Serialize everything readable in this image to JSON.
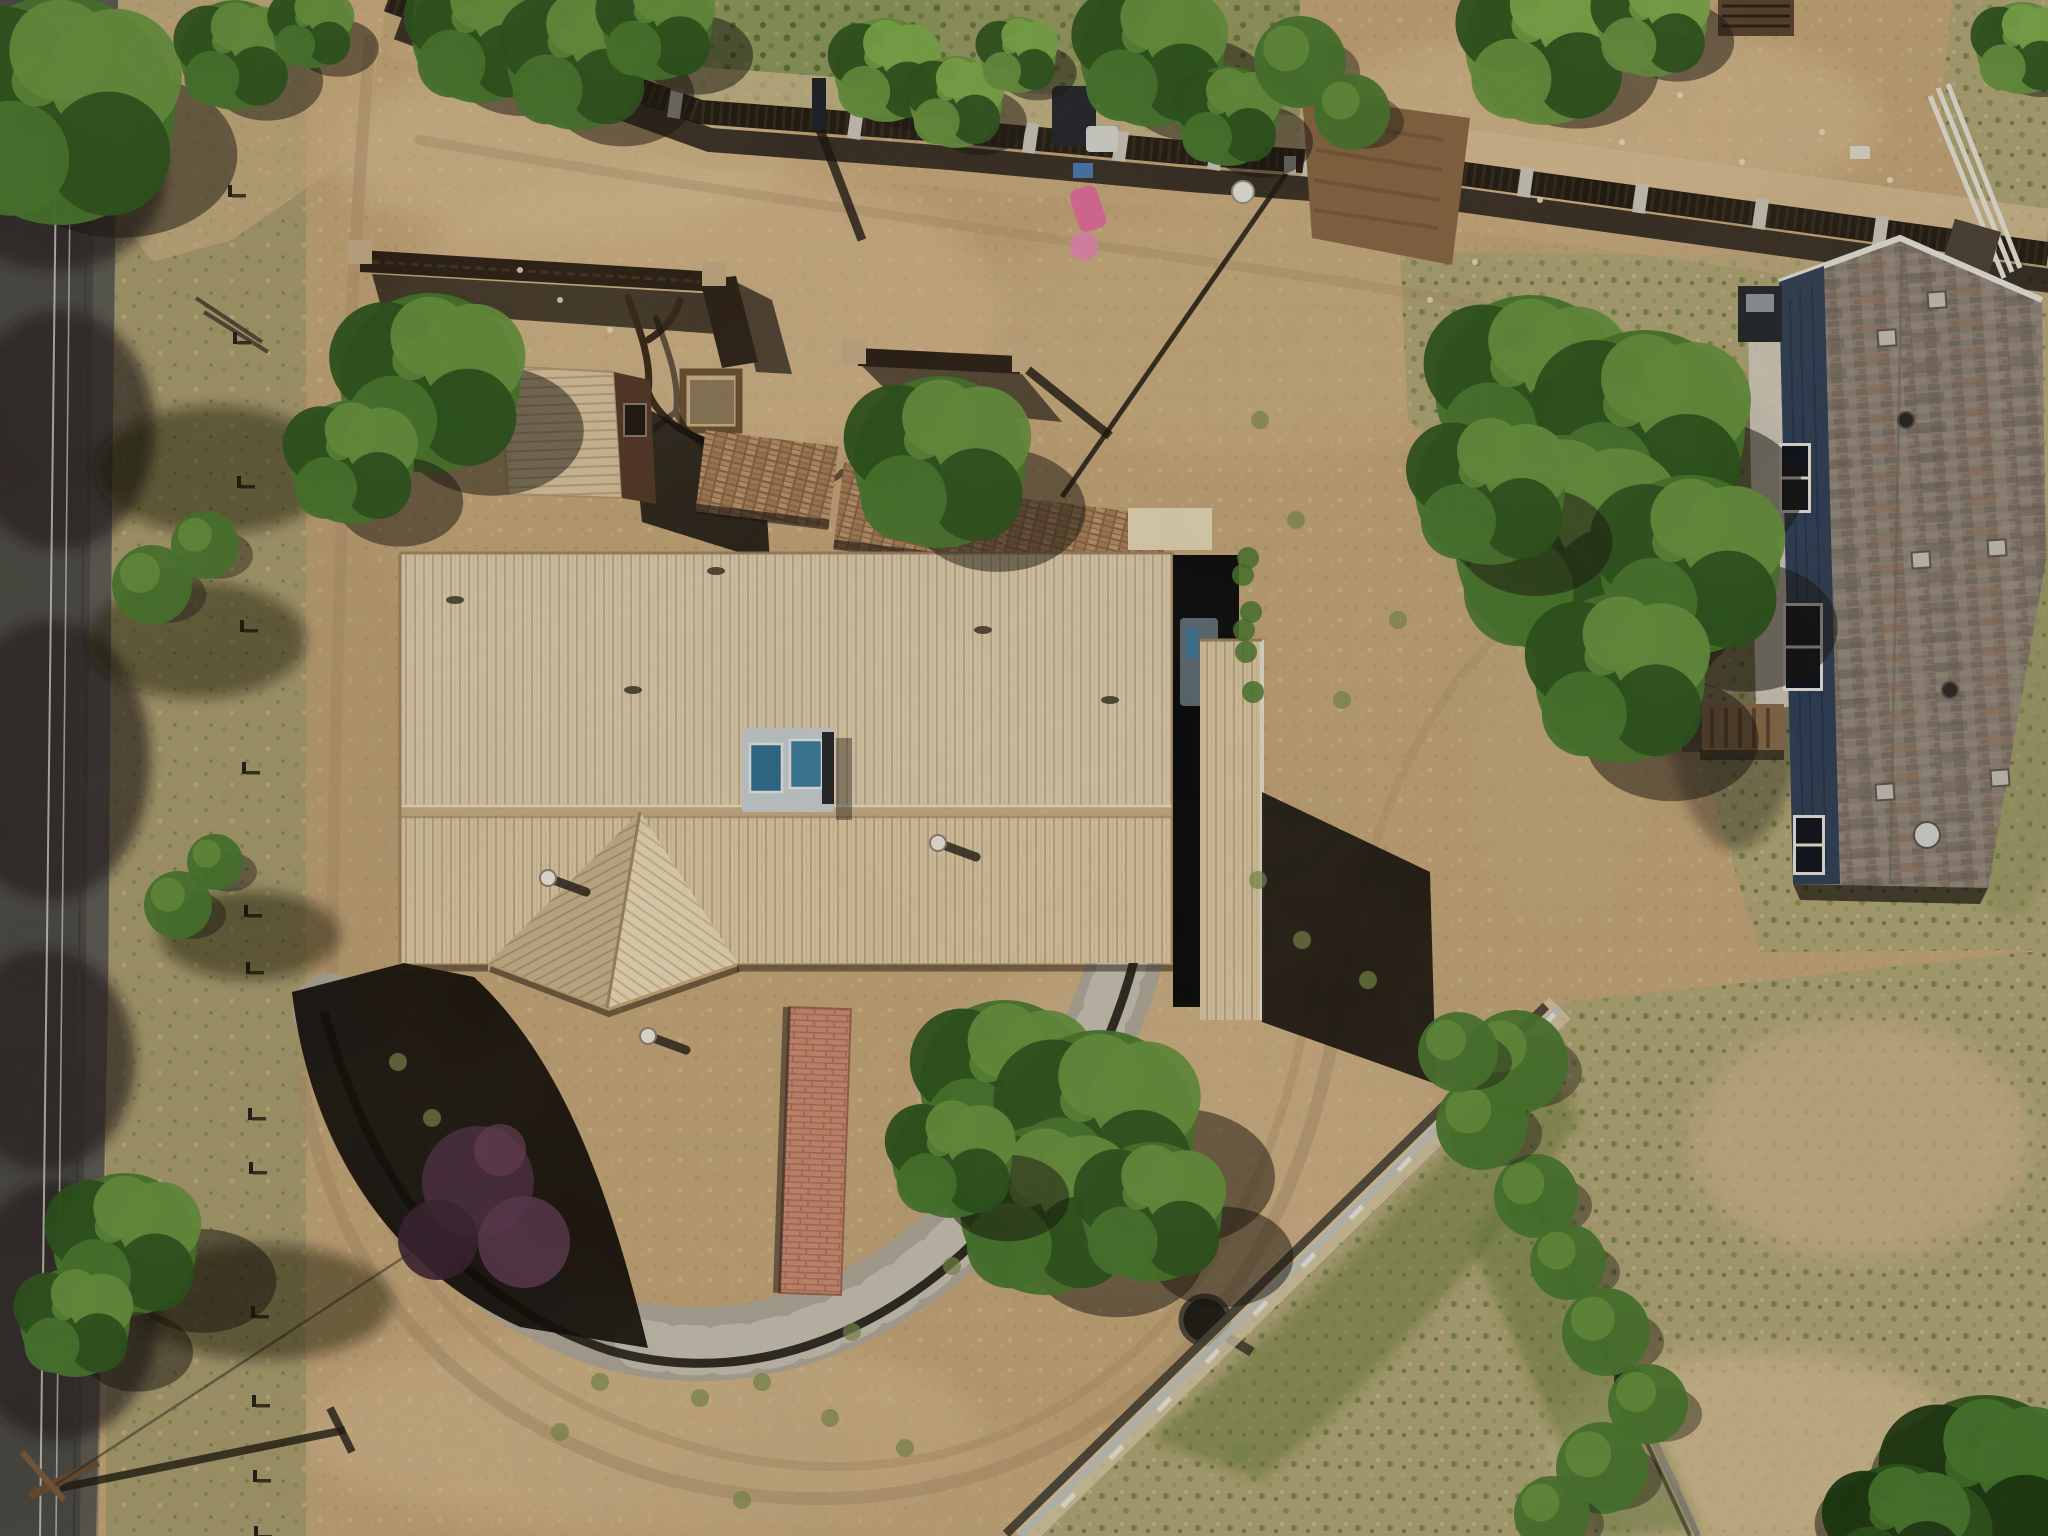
{
  "meta": {
    "image_kind": "aerial-drone-photo",
    "subject": "rural residential property, top-down view",
    "visible_text": ""
  },
  "palette": {
    "dirt_base": "#c7a87a",
    "dirt_light": "#dcbf94",
    "dirt_lighter": "#e8d0a6",
    "dirt_shade": "#b2946a",
    "track": "#b39识6e",
    "track_line": "#b1946b",
    "scrub": "#ab9e70",
    "grass_dry": "#b3a878",
    "grass_green": "#7f8f4e",
    "grass_dark": "#5a6a36",
    "road": "#4b4a45",
    "road_light": "#7b786f",
    "road_shadow": "#22211e",
    "wire": "#d9d9d2",
    "shadow": "#17130d",
    "tree_green": "#4a7a2e",
    "tree_light": "#69963f",
    "tree_dark": "#2e561d",
    "tree_bright": "#7fae4c",
    "roof_tan": "#e2cfab",
    "roof_rib": "#c3ab83",
    "roof_prow_left": "#cdb690",
    "roof_prow_right": "#eedebb",
    "roof_edge": "#9b835f",
    "shed_wall": "#54382а7",
    "shed_wall2": "#543827",
    "fence_dark": "#241d14",
    "post_concrete": "#d0cbbf",
    "corral": "#2e2217",
    "corral_post": "#c9b089",
    "brick": "#c08058",
    "brick_light": "#d49a7d",
    "bld_roof": "#8e8378",
    "bld_wall": "#304058",
    "bld_trim": "#e9e7df",
    "cooler_body": "#ccd3d6",
    "cooler_blue": "#2f6f92",
    "cooler_blue2": "#3b7fa0",
    "rock": "#b2aa9c",
    "rock_light": "#d2ccbd",
    "edging": "#141109",
    "shrub_purple": "#4c2d41",
    "fenceA": "#c3c5be",
    "fenceB": "#8d8577",
    "pole_wood": "#6b4f33",
    "bin_green": "#3faa3f",
    "toy_pink": "#e86fa0",
    "toy_blue": "#4a7ab8",
    "garden_soil": "#8a6844"
  },
  "scene": {
    "trees": [
      {
        "x": 60,
        "y": 110,
        "r": 115,
        "sx": 60,
        "sy": 45
      },
      {
        "x": 235,
        "y": 55,
        "r": 55,
        "sx": 32,
        "sy": 26
      },
      {
        "x": 312,
        "y": 28,
        "r": 40,
        "sx": 26,
        "sy": 20
      },
      {
        "x": 480,
        "y": 35,
        "r": 68,
        "sx": 42,
        "sy": 32
      },
      {
        "x": 577,
        "y": 60,
        "r": 70,
        "sx": 46,
        "sy": 36
      },
      {
        "x": 657,
        "y": 25,
        "r": 55,
        "sx": 40,
        "sy": 30
      },
      {
        "x": 886,
        "y": 70,
        "r": 52,
        "light": 1,
        "sx": 26,
        "sy": 22
      },
      {
        "x": 956,
        "y": 102,
        "r": 46,
        "light": 1,
        "sx": 24,
        "sy": 20
      },
      {
        "x": 1018,
        "y": 55,
        "r": 38,
        "light": 1,
        "sx": 20,
        "sy": 18
      },
      {
        "x": 1152,
        "y": 55,
        "r": 72,
        "sx": 45,
        "sy": 35
      },
      {
        "x": 1228,
        "y": 116,
        "r": 50,
        "sx": 34,
        "sy": 26
      },
      {
        "x": 1545,
        "y": 45,
        "r": 80,
        "light": 1,
        "sx": 32,
        "sy": 26
      },
      {
        "x": 1652,
        "y": 22,
        "r": 55,
        "light": 1,
        "sx": 26,
        "sy": 20
      },
      {
        "x": 2022,
        "y": 48,
        "r": 46,
        "light": 1,
        "sx": 20,
        "sy": 16
      },
      {
        "x": 430,
        "y": 383,
        "r": 90,
        "sx": 62,
        "sy": 48
      },
      {
        "x": 352,
        "y": 462,
        "r": 62,
        "sx": 48,
        "sy": 40
      },
      {
        "x": 940,
        "y": 462,
        "r": 86,
        "sx": 58,
        "sy": 48
      },
      {
        "x": 1530,
        "y": 390,
        "r": 95,
        "sx": 52,
        "sy": 58
      },
      {
        "x": 1645,
        "y": 430,
        "r": 100,
        "sx": 56,
        "sy": 62
      },
      {
        "x": 1565,
        "y": 545,
        "r": 110,
        "sx": 62,
        "sy": 66
      },
      {
        "x": 1690,
        "y": 565,
        "r": 90,
        "sx": 56,
        "sy": 62
      },
      {
        "x": 1490,
        "y": 490,
        "r": 75,
        "sx": 46,
        "sy": 52
      },
      {
        "x": 1620,
        "y": 678,
        "r": 85,
        "sx": 52,
        "sy": 62
      },
      {
        "x": 1005,
        "y": 1085,
        "r": 85,
        "sx": 72,
        "sy": 46
      },
      {
        "x": 1100,
        "y": 1125,
        "r": 95,
        "sx": 78,
        "sy": 52
      },
      {
        "x": 1045,
        "y": 1210,
        "r": 85,
        "sx": 72,
        "sy": 46
      },
      {
        "x": 1152,
        "y": 1212,
        "r": 70,
        "sx": 70,
        "sy": 45
      },
      {
        "x": 952,
        "y": 1158,
        "r": 60,
        "sx": 56,
        "sy": 40
      },
      {
        "x": 125,
        "y": 1245,
        "r": 72,
        "sx": 78,
        "sy": 36
      },
      {
        "x": 75,
        "y": 1322,
        "r": 55,
        "sx": 62,
        "sy": 30
      },
      {
        "x": 1985,
        "y": 1490,
        "r": 95,
        "dark": 1,
        "sx": -18,
        "sy": -10
      },
      {
        "x": 1898,
        "y": 1532,
        "r": 68,
        "dark": 1,
        "sx": -14,
        "sy": -8
      }
    ],
    "bushes": [
      {
        "x": 1536,
        "y": 1196,
        "r": 42
      },
      {
        "x": 1568,
        "y": 1262,
        "r": 38
      },
      {
        "x": 1606,
        "y": 1332,
        "r": 44
      },
      {
        "x": 1648,
        "y": 1404,
        "r": 40
      },
      {
        "x": 1602,
        "y": 1468,
        "r": 46
      },
      {
        "x": 1552,
        "y": 1514,
        "r": 38
      },
      {
        "x": 1516,
        "y": 1062,
        "r": 52
      },
      {
        "x": 1482,
        "y": 1124,
        "r": 46
      },
      {
        "x": 1458,
        "y": 1052,
        "r": 40
      },
      {
        "x": 1300,
        "y": 62,
        "r": 46
      },
      {
        "x": 1352,
        "y": 112,
        "r": 38
      },
      {
        "x": 178,
        "y": 905,
        "r": 34
      },
      {
        "x": 215,
        "y": 862,
        "r": 28
      },
      {
        "x": 152,
        "y": 585,
        "r": 40
      },
      {
        "x": 205,
        "y": 545,
        "r": 34
      }
    ],
    "weed_dots": [
      [
        600,
        1382
      ],
      [
        700,
        1398
      ],
      [
        762,
        1382
      ],
      [
        852,
        1332
      ],
      [
        952,
        1266
      ],
      [
        1032,
        1182
      ],
      [
        830,
        1418
      ],
      [
        560,
        1432
      ],
      [
        905,
        1448
      ],
      [
        1240,
        1452
      ],
      [
        742,
        1500
      ],
      [
        432,
        1118
      ],
      [
        398,
        1062
      ],
      [
        1302,
        940
      ],
      [
        1368,
        980
      ],
      [
        1258,
        880
      ],
      [
        1342,
        700
      ],
      [
        1398,
        620
      ],
      [
        1296,
        520
      ],
      [
        1260,
        420
      ]
    ],
    "fence_top_posts": [
      [
        420,
        11
      ],
      [
        505,
        42
      ],
      [
        590,
        73
      ],
      [
        675,
        103
      ],
      [
        855,
        124
      ],
      [
        940,
        130
      ],
      [
        1030,
        138
      ],
      [
        1120,
        146
      ],
      [
        1215,
        155
      ],
      [
        1310,
        162
      ],
      [
        1420,
        170
      ],
      [
        1525,
        182
      ],
      [
        1640,
        198
      ],
      [
        1760,
        214
      ],
      [
        1880,
        231
      ],
      [
        1990,
        246
      ]
    ],
    "verge_posts": [
      [
        228,
        185
      ],
      [
        233,
        332
      ],
      [
        237,
        476
      ],
      [
        240,
        620
      ],
      [
        242,
        762
      ],
      [
        244,
        905
      ],
      [
        246,
        962
      ],
      [
        248,
        1108
      ],
      [
        249,
        1162
      ],
      [
        251,
        1306
      ],
      [
        252,
        1395
      ],
      [
        253,
        1470
      ],
      [
        254,
        1526
      ]
    ],
    "fenceA_posts": [
      [
        1548,
        1020
      ],
      [
        1500,
        1068
      ],
      [
        1452,
        1116
      ],
      [
        1404,
        1164
      ],
      [
        1356,
        1212
      ],
      [
        1308,
        1260
      ],
      [
        1260,
        1308
      ],
      [
        1212,
        1356
      ],
      [
        1164,
        1404
      ],
      [
        1116,
        1452
      ],
      [
        1068,
        1500
      ]
    ],
    "roof_vents": [
      {
        "x": 548,
        "y": 878
      },
      {
        "x": 648,
        "y": 1036
      },
      {
        "x": 938,
        "y": 843
      },
      {
        "x": 1498,
        "y": 1020,
        "skip": 1
      }
    ],
    "roof_specks": [
      [
        716,
        571
      ],
      [
        633,
        690
      ],
      [
        983,
        630
      ],
      [
        1110,
        700
      ],
      [
        455,
        600
      ]
    ],
    "bld_vents": [
      [
        1886,
        338
      ],
      [
        1920,
        560
      ],
      [
        1884,
        792
      ],
      [
        1996,
        548
      ],
      [
        1999,
        778
      ],
      [
        1936,
        300
      ]
    ],
    "bld_pipes": [
      [
        1906,
        420
      ],
      [
        1950,
        690
      ],
      [
        1927,
        835
      ]
    ],
    "bld_windows": [
      {
        "x": 1782,
        "y": 446,
        "w": 26,
        "h": 64
      },
      {
        "x": 1786,
        "y": 606,
        "w": 34,
        "h": 82
      },
      {
        "x": 1796,
        "y": 818,
        "w": 26,
        "h": 54
      }
    ],
    "road_shadow_blobs": [
      [
        55,
        180,
        110,
        90
      ],
      [
        60,
        430,
        95,
        120
      ],
      [
        50,
        760,
        100,
        140
      ],
      [
        45,
        1060,
        90,
        110
      ],
      [
        60,
        1310,
        100,
        130
      ]
    ],
    "verge_shadow_blobs": [
      [
        215,
        470,
        120,
        64
      ],
      [
        196,
        640,
        110,
        58
      ],
      [
        262,
        1302,
        130,
        58
      ],
      [
        250,
        935,
        90,
        44
      ]
    ],
    "vine_dots": [
      [
        1243,
        575
      ],
      [
        1251,
        612
      ],
      [
        1246,
        652
      ],
      [
        1253,
        692
      ],
      [
        1248,
        558
      ],
      [
        1244,
        630
      ]
    ],
    "rock_dots": [
      [
        1560,
        90
      ],
      [
        1622,
        142
      ],
      [
        1680,
        95
      ],
      [
        1540,
        200
      ],
      [
        1742,
        162
      ],
      [
        1822,
        132
      ],
      [
        1890,
        180
      ],
      [
        560,
        300
      ],
      [
        610,
        330
      ],
      [
        520,
        270
      ],
      [
        1475,
        262
      ],
      [
        1430,
        300
      ]
    ],
    "toys": {
      "bin": {
        "x": 969,
        "y": 72,
        "w": 32,
        "h": 56
      },
      "atv": {
        "x": 1052,
        "y": 86,
        "w": 44,
        "h": 60
      },
      "white_thing": {
        "x": 1086,
        "y": 126,
        "w": 32,
        "h": 26
      },
      "blue_thing": {
        "x": 1073,
        "y": 163,
        "w": 20,
        "h": 15
      },
      "pink_slide": {
        "x": 1068,
        "y": 192,
        "w": 28,
        "h": 44
      },
      "pink_ball": {
        "x": 1084,
        "y": 246,
        "r": 14
      },
      "bucket": {
        "x": 1243,
        "y": 192,
        "r": 11
      }
    }
  }
}
